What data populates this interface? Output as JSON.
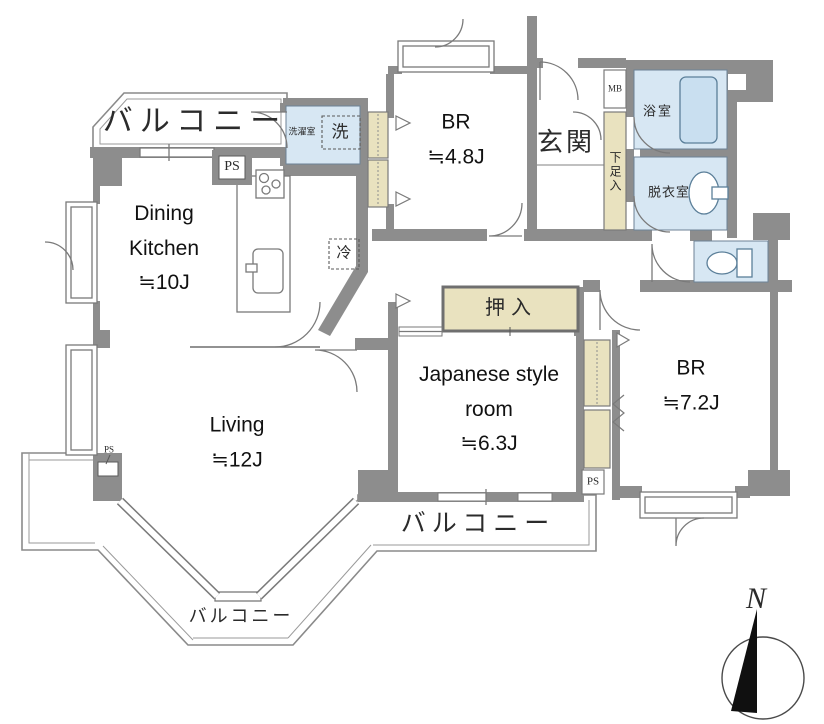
{
  "plan_title": "apartment floor plan",
  "rooms": {
    "dining_kitchen": {
      "name_line1": "Dining",
      "name_line2": "Kitchen",
      "size": "≒10J"
    },
    "living": {
      "name": "Living",
      "size": "≒12J"
    },
    "bedroom_48": {
      "name": "BR",
      "size": "≒4.8J"
    },
    "bedroom_72": {
      "name": "BR",
      "size": "≒7.2J"
    },
    "japanese_room": {
      "name_line1": "Japanese style",
      "name_line2": "room",
      "size": "≒6.3J"
    },
    "entrance": {
      "label": "玄関"
    },
    "bathroom": {
      "label": "浴室"
    },
    "dressing_room": {
      "label": "脱衣室"
    },
    "laundry_room": {
      "label": "洗濯室"
    },
    "closet": {
      "label": "押入"
    },
    "shoe_cabinet": {
      "label": "下足入"
    }
  },
  "fixtures": {
    "washing_machine": "洗",
    "refrigerator": "冷",
    "meter_box": "MB",
    "pipe_space": "PS"
  },
  "balconies": {
    "top": "バルコニー",
    "bottom_center": "バルコニー",
    "bottom_left": "バルコニー"
  },
  "compass": {
    "north": "N"
  },
  "colors": {
    "wall": "#8d8d8d",
    "wet_area": "#d7e7f3",
    "tub": "#c9dff0",
    "closet_fill": "#e9e2bf",
    "outline": "#7a7a7a"
  }
}
